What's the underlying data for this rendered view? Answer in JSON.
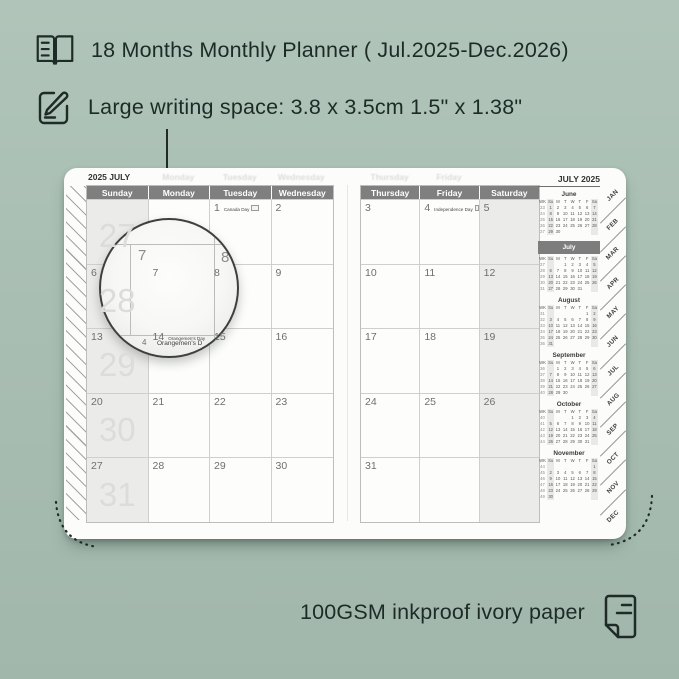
{
  "colors": {
    "background": "#a9beb3",
    "ink": "#1d2b27",
    "page": "#fcfcfa",
    "header_bar": "#7f7f7f",
    "weekend_fill": "#ebebe9",
    "grid_line": "#cfcfcd",
    "mini_current_bar": "#7d7d7d"
  },
  "features": {
    "top_items": [
      {
        "icon": "open-book-icon",
        "text": "18 Months Monthly Planner ( Jul.2025-Dec.2026)"
      },
      {
        "icon": "pencil-note-icon",
        "text": "Large writing space: 3.8 x 3.5cm 1.5\" x 1.38\""
      }
    ],
    "bottom": {
      "icon": "paper-icon",
      "text": "100GSM inkproof ivory paper"
    }
  },
  "planner": {
    "left_page": {
      "corner_label": "2025 JULY",
      "day_headers": [
        "Sunday",
        "Monday",
        "Tuesday",
        "Wednesday"
      ],
      "ghost_headers": [
        "",
        "Monday",
        "Tuesday",
        "Wednesday"
      ],
      "week_numbers": [
        "27",
        "28",
        "29",
        "30",
        "31"
      ],
      "rows": [
        [
          {
            "date": ""
          },
          {
            "date": ""
          },
          {
            "date": "1",
            "holiday": "Canada Day",
            "flag": "canada-flag-icon"
          },
          {
            "date": "2"
          }
        ],
        [
          {
            "date": "6"
          },
          {
            "date": "7"
          },
          {
            "date": "8"
          },
          {
            "date": "9"
          }
        ],
        [
          {
            "date": "13"
          },
          {
            "date": "14",
            "holiday": "Orangemen's Day"
          },
          {
            "date": "15"
          },
          {
            "date": "16"
          }
        ],
        [
          {
            "date": "20"
          },
          {
            "date": "21"
          },
          {
            "date": "22"
          },
          {
            "date": "23"
          }
        ],
        [
          {
            "date": "27"
          },
          {
            "date": "28"
          },
          {
            "date": "29"
          },
          {
            "date": "30"
          }
        ]
      ]
    },
    "right_page": {
      "day_headers": [
        "Thursday",
        "Friday",
        "Saturday"
      ],
      "ghost_headers": [
        "Thursday",
        "Friday",
        ""
      ],
      "rows": [
        [
          {
            "date": "3"
          },
          {
            "date": "4",
            "holiday": "Independence Day",
            "flag": "us-flag-icon"
          },
          {
            "date": "5"
          }
        ],
        [
          {
            "date": "10"
          },
          {
            "date": "11"
          },
          {
            "date": "12"
          }
        ],
        [
          {
            "date": "17"
          },
          {
            "date": "18"
          },
          {
            "date": "19"
          }
        ],
        [
          {
            "date": "24"
          },
          {
            "date": "25"
          },
          {
            "date": "26"
          }
        ],
        [
          {
            "date": "31"
          },
          {
            "date": ""
          },
          {
            "date": ""
          }
        ]
      ]
    },
    "sidebar": {
      "title": "JULY 2025",
      "mini_header": [
        "WK",
        "Su",
        "M",
        "T",
        "W",
        "T",
        "F",
        "Sa"
      ],
      "months": [
        {
          "name": "June",
          "current": false,
          "weeks": [
            [
              "23",
              "1",
              "2",
              "3",
              "4",
              "5",
              "6",
              "7"
            ],
            [
              "24",
              "8",
              "9",
              "10",
              "11",
              "12",
              "13",
              "14"
            ],
            [
              "25",
              "15",
              "16",
              "17",
              "18",
              "19",
              "20",
              "21"
            ],
            [
              "26",
              "22",
              "23",
              "24",
              "25",
              "26",
              "27",
              "28"
            ],
            [
              "27",
              "29",
              "30",
              "",
              "",
              "",
              "",
              ""
            ]
          ]
        },
        {
          "name": "July",
          "current": true,
          "weeks": [
            [
              "27",
              "",
              "",
              "1",
              "2",
              "3",
              "4",
              "5"
            ],
            [
              "28",
              "6",
              "7",
              "8",
              "9",
              "10",
              "11",
              "12"
            ],
            [
              "29",
              "13",
              "14",
              "15",
              "16",
              "17",
              "18",
              "19"
            ],
            [
              "30",
              "20",
              "21",
              "22",
              "23",
              "24",
              "25",
              "26"
            ],
            [
              "31",
              "27",
              "28",
              "29",
              "30",
              "31",
              "",
              ""
            ]
          ]
        },
        {
          "name": "August",
          "current": false,
          "weeks": [
            [
              "31",
              "",
              "",
              "",
              "",
              "",
              "1",
              "2"
            ],
            [
              "32",
              "3",
              "4",
              "5",
              "6",
              "7",
              "8",
              "9"
            ],
            [
              "33",
              "10",
              "11",
              "12",
              "13",
              "14",
              "15",
              "16"
            ],
            [
              "34",
              "17",
              "18",
              "19",
              "20",
              "21",
              "22",
              "23"
            ],
            [
              "35",
              "24",
              "25",
              "26",
              "27",
              "28",
              "29",
              "30"
            ],
            [
              "36",
              "31",
              "",
              "",
              "",
              "",
              "",
              ""
            ]
          ]
        },
        {
          "name": "September",
          "current": false,
          "weeks": [
            [
              "36",
              "",
              "1",
              "2",
              "3",
              "4",
              "5",
              "6"
            ],
            [
              "37",
              "7",
              "8",
              "9",
              "10",
              "11",
              "12",
              "13"
            ],
            [
              "38",
              "14",
              "15",
              "16",
              "17",
              "18",
              "19",
              "20"
            ],
            [
              "39",
              "21",
              "22",
              "23",
              "24",
              "25",
              "26",
              "27"
            ],
            [
              "40",
              "28",
              "29",
              "30",
              "",
              "",
              "",
              ""
            ]
          ]
        },
        {
          "name": "October",
          "current": false,
          "weeks": [
            [
              "40",
              "",
              "",
              "",
              "1",
              "2",
              "3",
              "4"
            ],
            [
              "41",
              "5",
              "6",
              "7",
              "8",
              "9",
              "10",
              "11"
            ],
            [
              "42",
              "12",
              "13",
              "14",
              "15",
              "16",
              "17",
              "18"
            ],
            [
              "43",
              "19",
              "20",
              "21",
              "22",
              "23",
              "24",
              "25"
            ],
            [
              "44",
              "26",
              "27",
              "28",
              "29",
              "30",
              "31",
              ""
            ]
          ]
        },
        {
          "name": "November",
          "current": false,
          "weeks": [
            [
              "44",
              "",
              "",
              "",
              "",
              "",
              "",
              "1"
            ],
            [
              "45",
              "2",
              "3",
              "4",
              "5",
              "6",
              "7",
              "8"
            ],
            [
              "46",
              "9",
              "10",
              "11",
              "12",
              "13",
              "14",
              "15"
            ],
            [
              "47",
              "16",
              "17",
              "18",
              "19",
              "20",
              "21",
              "22"
            ],
            [
              "48",
              "23",
              "24",
              "25",
              "26",
              "27",
              "28",
              "29"
            ],
            [
              "49",
              "30",
              "",
              "",
              "",
              "",
              "",
              ""
            ]
          ]
        }
      ]
    },
    "tabs": [
      "JAN",
      "FEB",
      "MAR",
      "APR",
      "MAY",
      "JUN",
      "JUL",
      "AUG",
      "SEP",
      "OCT",
      "NOV",
      "DEC"
    ]
  },
  "magnifier": {
    "zoom_day_1": "7",
    "zoom_day_2": "8",
    "clipped_date": "4",
    "clipped_holiday": "Orangemen's D"
  }
}
